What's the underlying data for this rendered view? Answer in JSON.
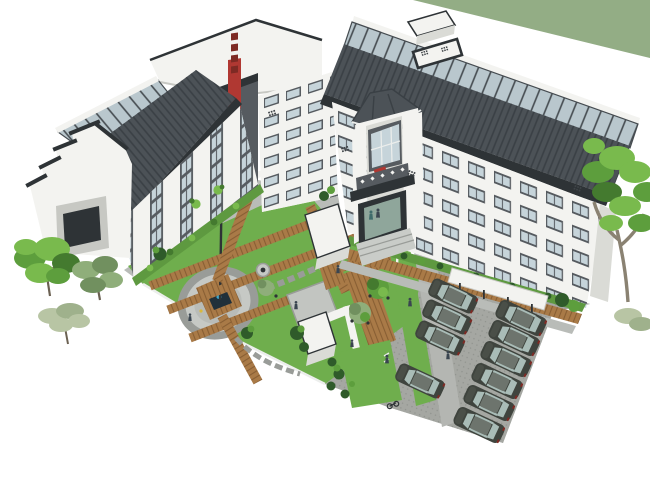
{
  "palette": {
    "bg": "#ffffff",
    "greenBand": "#93ad85",
    "roofDark": "#4c5257",
    "roofRib": "#3a4045",
    "roofLight": "#5d646a",
    "ridgeWhite": "#eceeec",
    "glass": "#b9c7cd",
    "glassFrame": "#454b50",
    "wallWhite": "#f3f3f0",
    "wallShade": "#dadbd6",
    "wallDark": "#c7c8c3",
    "bandDark": "#565b60",
    "winGlass": "#c6d4da",
    "trim": "#2e3336",
    "red": "#b03832",
    "redDark": "#7e2a24",
    "glyph": "#3f4448",
    "lawn": "#6fae4d",
    "lawnShade": "#5e9940",
    "wood": "#a97a47",
    "woodDark": "#855c31",
    "path": "#b9bcb8",
    "pathDark": "#999c98",
    "steps": "#c9ccc8",
    "parking": "#a5a7a2",
    "parkingDot": "#8f928d",
    "road": "#b4b6b2",
    "pond": "#20303a",
    "water": "#3fa8cc",
    "gold": "#d8b93e",
    "carBody": "#3f443e",
    "carRoof": "#6d746d",
    "carGlass": "#a9bcb7",
    "carDark": "#1e2224",
    "glassGreen": "#8fa69b",
    "treeBright": "#79ba4d",
    "treeMid": "#5d9e3d",
    "treeDark": "#447a2f",
    "treeOlive": "#8fae7a",
    "treeOliveDark": "#71905f",
    "treePale": "#b8c5a4",
    "treePaleDark": "#9fb18c",
    "shrubDark": "#2f5b2a",
    "trunk": "#8a8272",
    "trunkDark": "#6b6152",
    "person": "#3a4550"
  },
  "scene": {
    "type": "aerial-axonometric-architectural-rendering",
    "style": "chinese-courtyard-building-complex",
    "background": "white",
    "green_band": "sage diagonal band, top-right corner",
    "buildings": {
      "wings": [
        "left-wing-with-stepped-gable",
        "back-wing-flat-parapet-roof",
        "entrance-pagoda-tower",
        "long-right-wing"
      ],
      "roof": "dark tiled roofs with glass skylight strips",
      "facades": "white piers with dark window bands",
      "signs": [
        "vertical-red-sign-illegible",
        "rooftop-billboard-illegible",
        "red-balcony-plaque-illegible"
      ],
      "rooftop_structures": [
        "billboard",
        "stair-bulkhead-box"
      ]
    },
    "courtyard": {
      "features": [
        "lawns",
        "timber-plank-paths",
        "circular-plaza",
        "square-timber-deck-with-pond",
        "sculpture-pole",
        "white-canopy-boxes",
        "stepping-stone-paths",
        "manhole",
        "tree-deck-with-tables",
        "shrubs"
      ],
      "canopy_count": 2
    },
    "parking": {
      "car_count": 10,
      "columns": 2,
      "car_color": "dark gray",
      "surface": "textured pavers",
      "extras": [
        "bicycle"
      ]
    },
    "vegetation": {
      "left_tree_count": 3,
      "right_tree_count": 2,
      "shrub_rows": "along building bases"
    },
    "people_count": 9
  }
}
